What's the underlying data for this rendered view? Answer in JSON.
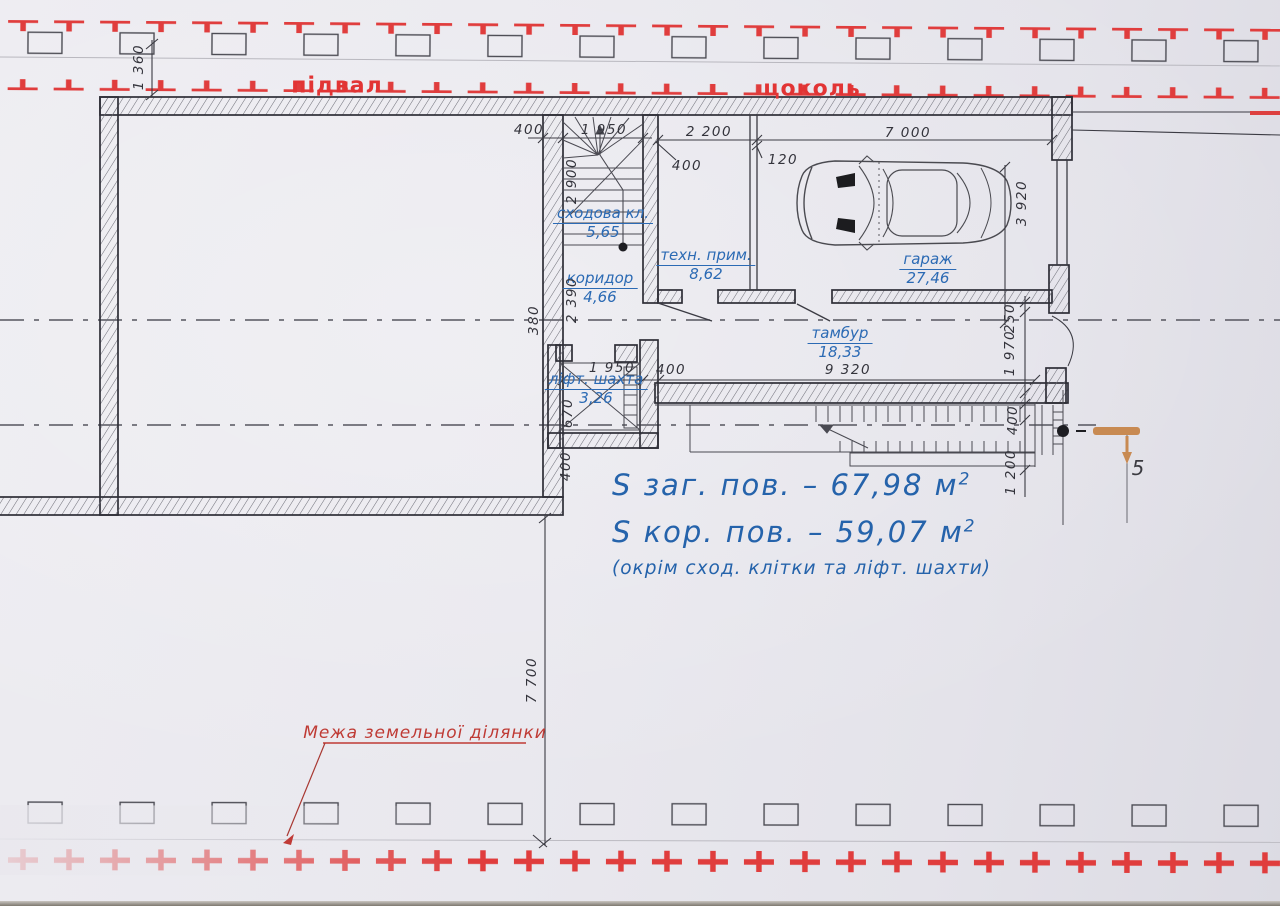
{
  "site": {
    "label_basement": "підвал",
    "label_ground": "цоколь",
    "boundary_label": "Межа земельної ділянки",
    "entry_marker": "5"
  },
  "rooms": {
    "stair": {
      "name": "сходова кл.",
      "area": "5,65"
    },
    "corridor": {
      "name": "коридор",
      "area": "4,66"
    },
    "tech": {
      "name": "техн. прим.",
      "area": "8,62"
    },
    "garage": {
      "name": "гараж",
      "area": "27,46"
    },
    "tambour": {
      "name": "тамбур",
      "area": "18,33"
    },
    "lift": {
      "name": "ліфт. шахта",
      "area": "3,26"
    }
  },
  "summary": {
    "total_text": "S заг.   пов. – 67,98 м",
    "total_sup": "2",
    "usable_text": "S кор.   пов. – 59,07 м",
    "usable_sup": "2",
    "note": "(окрім сход. клітки та ліфт. шахти)"
  },
  "dims": {
    "plot_offset": "1 360",
    "wall_400_top": "400",
    "stair_width": "1 950",
    "tech_width": "2 200",
    "garage_width": "7 000",
    "partition_120": "120",
    "tech_400": "400",
    "stair_height": "2 900",
    "corridor_height": "2 390",
    "wall_380": "380",
    "lift_width": "1 950",
    "lift_400": "400",
    "tambour_length": "9 320",
    "lift_670": "670",
    "shaft_400": "400",
    "garage_depth": "3 920",
    "wall_250": "250",
    "tambour_depth": "1 970",
    "right_400": "400",
    "stair_1200": "1 200",
    "plot_7700": "7 700"
  },
  "colors": {
    "cross_red": "#e03d3d",
    "blue_ink": "#2b6ab4",
    "orange_marker": "#c88a52"
  }
}
